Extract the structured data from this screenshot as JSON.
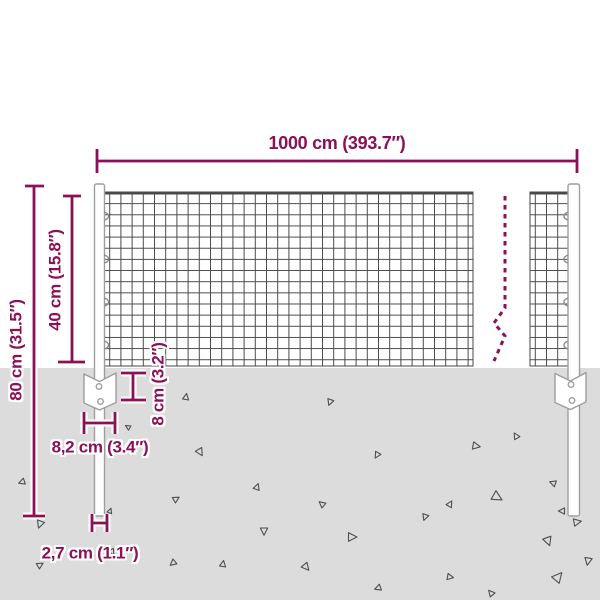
{
  "diagram": {
    "subject": "wire-mesh-fence-with-posts-dimension-diagram",
    "accent_color": "#8b1156",
    "halo_color": "#ffffff",
    "ground_color": "#dcdcdc",
    "mesh_color": "#4a4a4a",
    "outline_color": "#9e9e9e",
    "triangle_color": "#4f4f4f",
    "labels": {
      "total_width": "1000 cm (393.7″)",
      "mesh_height": "40 cm (15.8″)",
      "post_height": "80 cm (31.5″)",
      "plate_depth": "8 cm (3.2″)",
      "plate_width": "8,2 cm (3.4″)",
      "post_diameter": "2,7 cm (1.1″)"
    },
    "triangles": [
      [
        186,
        397,
        5,
        10
      ],
      [
        330,
        402,
        5,
        200
      ],
      [
        134,
        446,
        5,
        40
      ],
      [
        200,
        452,
        6,
        150
      ],
      [
        128,
        427,
        4,
        300
      ],
      [
        257,
        487,
        5,
        20
      ],
      [
        377,
        455,
        5,
        210
      ],
      [
        476,
        446,
        6,
        100
      ],
      [
        516,
        436,
        5,
        330
      ],
      [
        22,
        482,
        5,
        250
      ],
      [
        176,
        499,
        5,
        60
      ],
      [
        264,
        531,
        6,
        180
      ],
      [
        322,
        504,
        5,
        310
      ],
      [
        352,
        537,
        7,
        90
      ],
      [
        425,
        517,
        5,
        200
      ],
      [
        450,
        504,
        5,
        30
      ],
      [
        497,
        497,
        8,
        120
      ],
      [
        562,
        511,
        5,
        270
      ],
      [
        112,
        552,
        5,
        150
      ],
      [
        40,
        524,
        6,
        200
      ],
      [
        40,
        565,
        5,
        60
      ],
      [
        173,
        563,
        5,
        230
      ],
      [
        223,
        564,
        5,
        10
      ],
      [
        306,
        567,
        6,
        140
      ],
      [
        378,
        588,
        5,
        250
      ],
      [
        450,
        577,
        5,
        100
      ],
      [
        491,
        593,
        5,
        320
      ],
      [
        558,
        577,
        8,
        40
      ],
      [
        588,
        561,
        6,
        190
      ],
      [
        553,
        483,
        5,
        290
      ],
      [
        577,
        522,
        6,
        80
      ],
      [
        548,
        541,
        7,
        160
      ],
      [
        110,
        511,
        4,
        20
      ]
    ]
  }
}
